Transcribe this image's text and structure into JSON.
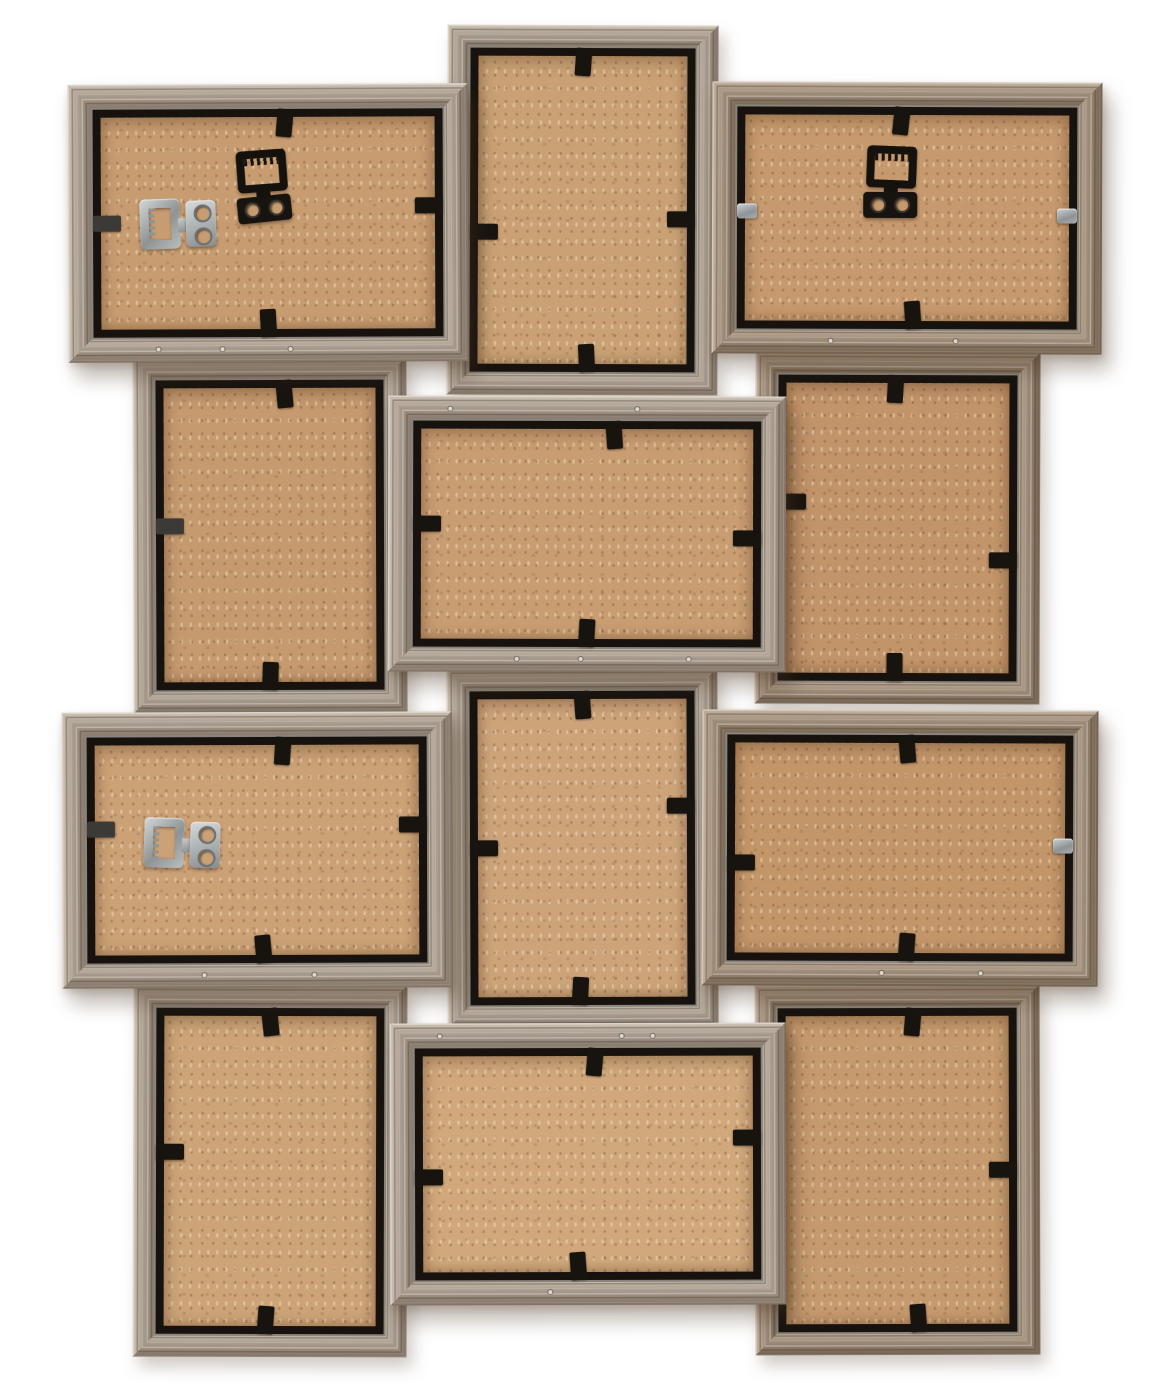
{
  "meta": {
    "subject": "Back view of a wooden 12-opening collage photo frame hanging arrangement",
    "background_color": "#ffffff"
  },
  "palette": {
    "wood_gray": {
      "l": "#cec4b6",
      "m": "#a89b8d",
      "d": "#807264"
    },
    "wood_warm": {
      "l": "#c4b4a0",
      "m": "#9e8c79",
      "d": "#71604d"
    },
    "gap_dark": "#17120e",
    "aluminum_edge": "#e8e4d8",
    "tab_black": "#17130f",
    "clip_metal": "#9aa0a3",
    "hardware_black": "#15120e",
    "hardware_metal": "#aeb3b5",
    "mdf_base": "#c99e71",
    "screw": "#ddd9d1"
  },
  "frames": [
    {
      "id": "P1",
      "name": "frame-back-portrait-top-center",
      "orientation": "portrait",
      "x": 447,
      "y": 25,
      "w": 271,
      "h": 370,
      "z": 1,
      "rot": 0.2,
      "tone": "gray",
      "mdf": "#c9a175",
      "rail": 24,
      "tabs": [
        {
          "side": "top",
          "frac": 0.5,
          "r": 4
        },
        {
          "side": "left",
          "frac": 0.57,
          "r": 0
        },
        {
          "side": "right",
          "frac": 0.53,
          "r": 0
        },
        {
          "side": "bottom",
          "frac": 0.52,
          "r": -3
        }
      ],
      "hardware": [],
      "screws": [
        {
          "side": "left",
          "frac": 0.3
        },
        {
          "side": "left",
          "frac": 0.7
        }
      ]
    },
    {
      "id": "P2",
      "name": "frame-back-portrait-mid-left",
      "orientation": "portrait",
      "x": 133,
      "y": 357,
      "w": 274,
      "h": 356,
      "z": 1,
      "rot": -0.2,
      "tone": "gray",
      "mdf": "#c59a6f",
      "rail": 24,
      "tabs": [
        {
          "side": "top",
          "frac": 0.57,
          "r": -5
        },
        {
          "side": "left",
          "frac": 0.47,
          "r": 0,
          "kind": "dark"
        },
        {
          "side": "bottom",
          "frac": 0.5,
          "r": 2
        }
      ],
      "hardware": [],
      "screws": []
    },
    {
      "id": "P3",
      "name": "frame-back-portrait-mid-right",
      "orientation": "portrait",
      "x": 755,
      "y": 352,
      "w": 285,
      "h": 352,
      "z": 1,
      "rot": 0.2,
      "tone": "warm",
      "mdf": "#c2946a",
      "rail": 24,
      "tabs": [
        {
          "side": "top",
          "frac": 0.49,
          "r": 3
        },
        {
          "side": "left",
          "frac": 0.41,
          "r": 0
        },
        {
          "side": "right",
          "frac": 0.61,
          "r": 0
        },
        {
          "side": "bottom",
          "frac": 0.49,
          "r": 0
        }
      ],
      "hardware": [],
      "screws": []
    },
    {
      "id": "P4",
      "name": "frame-back-portrait-lower-center",
      "orientation": "portrait",
      "x": 447,
      "y": 668,
      "w": 271,
      "h": 360,
      "z": 1,
      "rot": -0.2,
      "tone": "gray",
      "mdf": "#cda47a",
      "rail": 24,
      "tabs": [
        {
          "side": "top",
          "frac": 0.5,
          "r": -4
        },
        {
          "side": "left",
          "frac": 0.5,
          "r": 0
        },
        {
          "side": "right",
          "frac": 0.36,
          "r": 0
        },
        {
          "side": "bottom",
          "frac": 0.49,
          "r": 3
        }
      ],
      "hardware": [],
      "screws": []
    },
    {
      "id": "P5",
      "name": "frame-back-portrait-bottom-left",
      "orientation": "portrait",
      "x": 133,
      "y": 985,
      "w": 274,
      "h": 372,
      "z": 1,
      "rot": 0.15,
      "tone": "gray",
      "mdf": "#cca478",
      "rail": 24,
      "tabs": [
        {
          "side": "top",
          "frac": 0.5,
          "r": -6
        },
        {
          "side": "left",
          "frac": 0.44,
          "r": 0
        },
        {
          "side": "bottom",
          "frac": 0.48,
          "r": 4
        }
      ],
      "hardware": [],
      "screws": []
    },
    {
      "id": "P6",
      "name": "frame-back-portrait-bottom-right",
      "orientation": "portrait",
      "x": 755,
      "y": 985,
      "w": 285,
      "h": 370,
      "z": 1,
      "rot": -0.15,
      "tone": "warm",
      "mdf": "#c59a6e",
      "rail": 24,
      "tabs": [
        {
          "side": "top",
          "frac": 0.57,
          "r": 5
        },
        {
          "side": "right",
          "frac": 0.5,
          "r": 0
        },
        {
          "side": "bottom",
          "frac": 0.59,
          "r": -4
        }
      ],
      "hardware": [],
      "screws": []
    },
    {
      "id": "L1",
      "name": "frame-back-landscape-top-left",
      "orientation": "landscape",
      "x": 68,
      "y": 84,
      "w": 400,
      "h": 278,
      "z": 2,
      "rot": -0.25,
      "tone": "gray",
      "mdf": "#c79c70",
      "rail": 26,
      "tabs": [
        {
          "side": "top",
          "frac": 0.55,
          "r": 5
        },
        {
          "side": "left",
          "frac": 0.5,
          "r": 0,
          "kind": "dark"
        },
        {
          "side": "right",
          "frac": 0.42,
          "r": 0
        },
        {
          "side": "bottom",
          "frac": 0.5,
          "r": -3
        }
      ],
      "hardware": [
        {
          "type": "metal",
          "x": 72,
          "y": 112,
          "rot": -2
        },
        {
          "type": "black",
          "x": 168,
          "y": 66,
          "rot": -4
        }
      ],
      "screws": [
        {
          "side": "bottom",
          "frac": 0.22
        },
        {
          "side": "bottom",
          "frac": 0.38
        },
        {
          "side": "bottom",
          "frac": 0.55
        }
      ]
    },
    {
      "id": "L2",
      "name": "frame-back-landscape-top-right",
      "orientation": "landscape",
      "x": 712,
      "y": 82,
      "w": 390,
      "h": 272,
      "z": 2,
      "rot": 0.2,
      "tone": "warm",
      "mdf": "#c69a6e",
      "rail": 26,
      "tabs": [
        {
          "side": "top",
          "frac": 0.48,
          "r": 6
        },
        {
          "side": "left",
          "frac": 0.47,
          "r": 0,
          "kind": "metal"
        },
        {
          "side": "right",
          "frac": 0.49,
          "r": 0,
          "kind": "metal"
        },
        {
          "side": "bottom",
          "frac": 0.52,
          "r": -4
        }
      ],
      "hardware": [
        {
          "type": "black",
          "x": 152,
          "y": 64,
          "rot": 2
        }
      ],
      "screws": [
        {
          "side": "bottom",
          "frac": 0.3
        },
        {
          "side": "bottom",
          "frac": 0.62
        }
      ]
    },
    {
      "id": "L3",
      "name": "frame-back-landscape-middle-center",
      "orientation": "landscape",
      "x": 388,
      "y": 396,
      "w": 398,
      "h": 276,
      "z": 2,
      "rot": 0.15,
      "tone": "gray",
      "mdf": "#c89d72",
      "rail": 26,
      "tabs": [
        {
          "side": "top",
          "frac": 0.58,
          "r": -4
        },
        {
          "side": "left",
          "frac": 0.45,
          "r": 0
        },
        {
          "side": "right",
          "frac": 0.52,
          "r": 0
        },
        {
          "side": "bottom",
          "frac": 0.5,
          "r": 3
        }
      ],
      "hardware": [],
      "screws": [
        {
          "side": "top",
          "frac": 0.15
        },
        {
          "side": "top",
          "frac": 0.62
        },
        {
          "side": "bottom",
          "frac": 0.32
        },
        {
          "side": "bottom",
          "frac": 0.48
        },
        {
          "side": "bottom",
          "frac": 0.75
        }
      ]
    },
    {
      "id": "L4",
      "name": "frame-back-landscape-lower-left",
      "orientation": "landscape",
      "x": 62,
      "y": 712,
      "w": 390,
      "h": 276,
      "z": 2,
      "rot": -0.2,
      "tone": "gray",
      "mdf": "#cba176",
      "rail": 26,
      "tabs": [
        {
          "side": "top",
          "frac": 0.58,
          "r": 4
        },
        {
          "side": "left",
          "frac": 0.4,
          "r": 0,
          "kind": "dark"
        },
        {
          "side": "right",
          "frac": 0.38,
          "r": 0
        },
        {
          "side": "bottom",
          "frac": 0.52,
          "r": -5
        }
      ],
      "hardware": [
        {
          "type": "metal",
          "x": 82,
          "y": 104,
          "rot": 2
        }
      ],
      "screws": [
        {
          "side": "bottom",
          "frac": 0.36
        },
        {
          "side": "bottom",
          "frac": 0.64
        }
      ]
    },
    {
      "id": "L5",
      "name": "frame-back-landscape-lower-right",
      "orientation": "landscape",
      "x": 702,
      "y": 710,
      "w": 396,
      "h": 276,
      "z": 2,
      "rot": 0.2,
      "tone": "warm",
      "mdf": "#c3966a",
      "rail": 26,
      "tabs": [
        {
          "side": "top",
          "frac": 0.52,
          "r": -5
        },
        {
          "side": "left",
          "frac": 0.57,
          "r": 0
        },
        {
          "side": "right",
          "frac": 0.49,
          "r": 0,
          "kind": "metal"
        },
        {
          "side": "bottom",
          "frac": 0.52,
          "r": 4
        }
      ],
      "hardware": [],
      "screws": [
        {
          "side": "bottom",
          "frac": 0.45
        },
        {
          "side": "bottom",
          "frac": 0.7
        }
      ]
    },
    {
      "id": "L6",
      "name": "frame-back-landscape-bottom-center",
      "orientation": "landscape",
      "x": 390,
      "y": 1023,
      "w": 396,
      "h": 282,
      "z": 2,
      "rot": -0.15,
      "tone": "gray",
      "mdf": "#d0a87c",
      "rail": 26,
      "tabs": [
        {
          "side": "top",
          "frac": 0.52,
          "r": 5
        },
        {
          "side": "left",
          "frac": 0.56,
          "r": 0
        },
        {
          "side": "right",
          "frac": 0.38,
          "r": 0
        },
        {
          "side": "bottom",
          "frac": 0.47,
          "r": -4
        }
      ],
      "hardware": [],
      "screws": [
        {
          "side": "top",
          "frac": 0.12
        },
        {
          "side": "top",
          "frac": 0.58
        },
        {
          "side": "top",
          "frac": 0.66
        },
        {
          "side": "bottom",
          "frac": 0.4
        }
      ]
    }
  ],
  "hardware_types": {
    "black": "black-sawtooth-hanger-with-screw-plate",
    "metal": "metal-sawtooth-hanger-with-screw-plate"
  }
}
